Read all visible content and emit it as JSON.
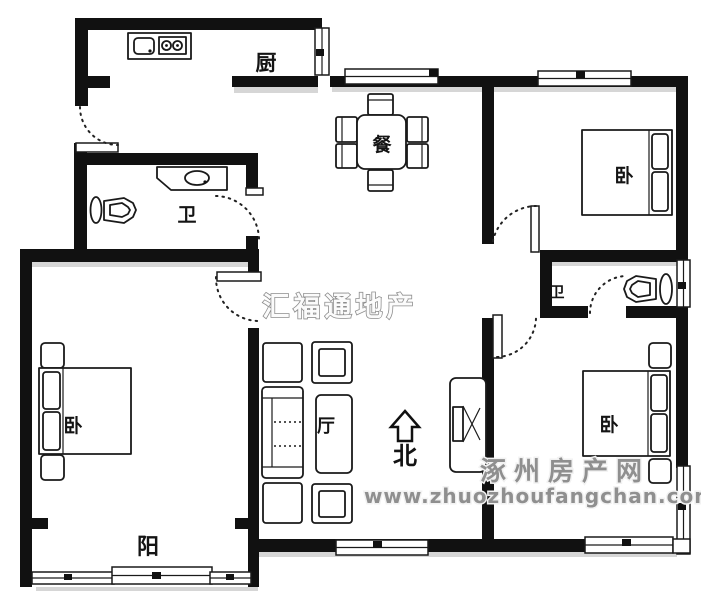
{
  "floorplan": {
    "rooms": {
      "kitchen": {
        "label": "厨"
      },
      "dining": {
        "label": "餐"
      },
      "bathroom_left": {
        "label": "卫"
      },
      "bathroom_right": {
        "label": "卫"
      },
      "bedroom_top_right": {
        "label": "卧"
      },
      "bedroom_bottom_left": {
        "label": "卧"
      },
      "bedroom_bottom_right": {
        "label": "卧"
      },
      "living_room": {
        "label": "厅"
      },
      "balcony": {
        "label": "阳"
      }
    },
    "compass": {
      "north_label": "北"
    },
    "watermarks": {
      "agency": "汇福通地产",
      "site_name": "涿州房产网",
      "site_url": "www.zhuozhoufangchan.com"
    },
    "colors": {
      "wall": "#111111",
      "background": "#ffffff",
      "watermark_gray": "#8f8f8f"
    }
  }
}
